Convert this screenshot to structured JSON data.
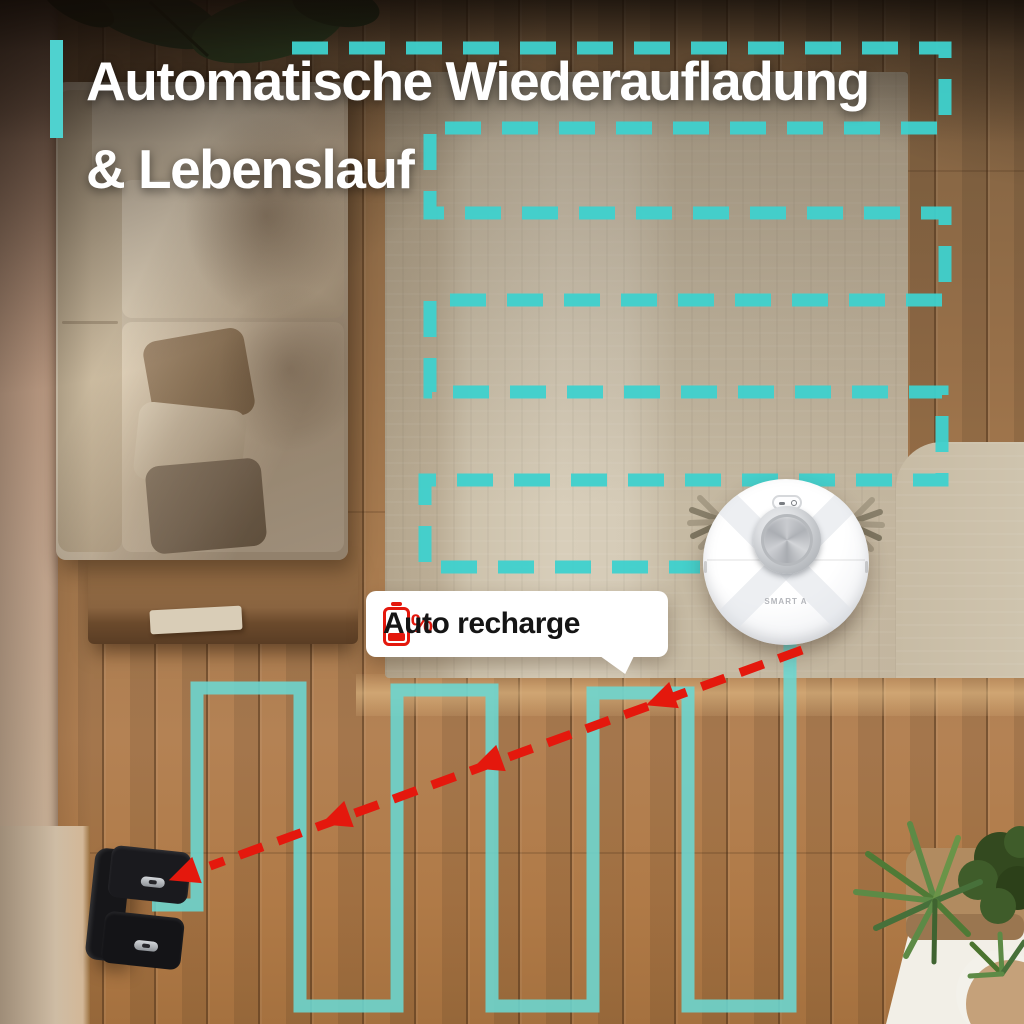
{
  "title": {
    "line1": "Automatische Wiederaufladung",
    "line2": "& Lebenslauf"
  },
  "callout": {
    "percent": "20%",
    "label": "Auto recharge"
  },
  "robot": {
    "brand": "SMART A"
  },
  "colors": {
    "path_teal": "#3ed1ce",
    "return_teal": "#6bd7d2",
    "alert_red": "#e4180d",
    "headline": "#ffffff",
    "callout_text": "#151515",
    "accent_bar": "#4fd2cf"
  }
}
